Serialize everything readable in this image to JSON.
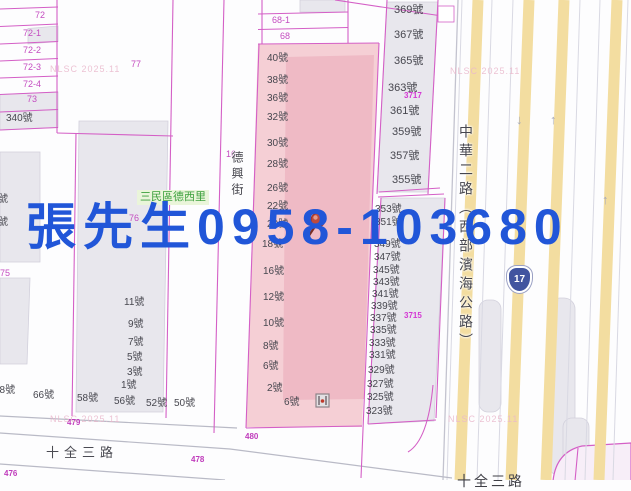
{
  "watermark": {
    "phone": "張先生0958-103680",
    "phone_color": "#2156d8",
    "copyright": "NLSC 2025.11"
  },
  "streets": {
    "dexing": "德興街",
    "zhonghua": "中華二路（西部濱海公路）",
    "shiquan_bottom": "十全三路",
    "shiquan_right": "十全三路",
    "district": "三民區德西里"
  },
  "highway_shield": "17",
  "icons": {
    "arrow_down": "↓",
    "arrow_up": "↑"
  },
  "map_colors": {
    "parcel_line": "#d45fc6",
    "highlight_parcel_fill": "#f5cfd5",
    "highlight_parcel_inner": "#efbac5",
    "building_fill": "#e8e7ed",
    "lane_stripe": "#f3dda0"
  },
  "labels": {
    "addresses": [
      {
        "t": "40號",
        "x": 267,
        "y": 54
      },
      {
        "t": "38號",
        "x": 267,
        "y": 76
      },
      {
        "t": "36號",
        "x": 267,
        "y": 94
      },
      {
        "t": "32號",
        "x": 267,
        "y": 113
      },
      {
        "t": "30號",
        "x": 267,
        "y": 139
      },
      {
        "t": "28號",
        "x": 267,
        "y": 160
      },
      {
        "t": "26號",
        "x": 267,
        "y": 184
      },
      {
        "t": "22號",
        "x": 267,
        "y": 202
      },
      {
        "t": "20號",
        "x": 267,
        "y": 220
      },
      {
        "t": "18號",
        "x": 262,
        "y": 240
      },
      {
        "t": "16號",
        "x": 263,
        "y": 267
      },
      {
        "t": "12號",
        "x": 263,
        "y": 293
      },
      {
        "t": "10號",
        "x": 263,
        "y": 319
      },
      {
        "t": "8號",
        "x": 263,
        "y": 342
      },
      {
        "t": "6號",
        "x": 263,
        "y": 362
      },
      {
        "t": "2號",
        "x": 267,
        "y": 384
      },
      {
        "t": "6號",
        "x": 284,
        "y": 398
      },
      {
        "t": "369號",
        "x": 394,
        "y": 5,
        "s": 11
      },
      {
        "t": "367號",
        "x": 394,
        "y": 30,
        "s": 11
      },
      {
        "t": "365號",
        "x": 394,
        "y": 56,
        "s": 11
      },
      {
        "t": "363號",
        "x": 388,
        "y": 83,
        "s": 11
      },
      {
        "t": "361號",
        "x": 390,
        "y": 106,
        "s": 11
      },
      {
        "t": "359號",
        "x": 392,
        "y": 127,
        "s": 11
      },
      {
        "t": "357號",
        "x": 390,
        "y": 151,
        "s": 11
      },
      {
        "t": "355號",
        "x": 392,
        "y": 175,
        "s": 11
      },
      {
        "t": "353號",
        "x": 375,
        "y": 205
      },
      {
        "t": "351號",
        "x": 375,
        "y": 218
      },
      {
        "t": "349號",
        "x": 374,
        "y": 240
      },
      {
        "t": "347號",
        "x": 374,
        "y": 253
      },
      {
        "t": "345號",
        "x": 373,
        "y": 266
      },
      {
        "t": "343號",
        "x": 373,
        "y": 278
      },
      {
        "t": "341號",
        "x": 372,
        "y": 290
      },
      {
        "t": "339號",
        "x": 371,
        "y": 302
      },
      {
        "t": "337號",
        "x": 370,
        "y": 314
      },
      {
        "t": "335號",
        "x": 370,
        "y": 326
      },
      {
        "t": "333號",
        "x": 369,
        "y": 339
      },
      {
        "t": "331號",
        "x": 369,
        "y": 351
      },
      {
        "t": "329號",
        "x": 368,
        "y": 366
      },
      {
        "t": "327號",
        "x": 367,
        "y": 380
      },
      {
        "t": "325號",
        "x": 367,
        "y": 393
      },
      {
        "t": "323號",
        "x": 366,
        "y": 407
      },
      {
        "t": "11號",
        "x": 124,
        "y": 298
      },
      {
        "t": "9號",
        "x": 128,
        "y": 320
      },
      {
        "t": "7號",
        "x": 128,
        "y": 338
      },
      {
        "t": "5號",
        "x": 127,
        "y": 353
      },
      {
        "t": "3號",
        "x": 127,
        "y": 368
      },
      {
        "t": "1號",
        "x": 121,
        "y": 381
      },
      {
        "t": "68號",
        "x": -6,
        "y": 386
      },
      {
        "t": "66號",
        "x": 33,
        "y": 391
      },
      {
        "t": "58號",
        "x": 77,
        "y": 394
      },
      {
        "t": "56號",
        "x": 114,
        "y": 397
      },
      {
        "t": "52號",
        "x": 146,
        "y": 399
      },
      {
        "t": "50號",
        "x": 174,
        "y": 399
      },
      {
        "t": "340號",
        "x": 6,
        "y": 114
      },
      {
        "t": "號",
        "x": -2,
        "y": 195
      },
      {
        "t": "號",
        "x": -2,
        "y": 218
      }
    ],
    "parcel_ids": [
      {
        "t": "72",
        "x": 35,
        "y": 11
      },
      {
        "t": "72-1",
        "x": 23,
        "y": 29
      },
      {
        "t": "72-2",
        "x": 23,
        "y": 46
      },
      {
        "t": "72-3",
        "x": 23,
        "y": 63
      },
      {
        "t": "72-4",
        "x": 23,
        "y": 80
      },
      {
        "t": "73",
        "x": 27,
        "y": 95
      },
      {
        "t": "77",
        "x": 131,
        "y": 60
      },
      {
        "t": "76",
        "x": 129,
        "y": 214
      },
      {
        "t": "75",
        "x": 0,
        "y": 269
      },
      {
        "t": "16",
        "x": 226,
        "y": 150
      },
      {
        "t": "68-1",
        "x": 272,
        "y": 16
      },
      {
        "t": "68",
        "x": 280,
        "y": 32
      }
    ],
    "lot_ids": [
      {
        "t": "3717",
        "x": 404,
        "y": 92
      },
      {
        "t": "3715",
        "x": 404,
        "y": 312
      }
    ],
    "road_ids": [
      {
        "t": "479",
        "x": 67,
        "y": 419
      },
      {
        "t": "480",
        "x": 245,
        "y": 433
      },
      {
        "t": "478",
        "x": 191,
        "y": 456
      },
      {
        "t": "476",
        "x": 4,
        "y": 470
      }
    ]
  }
}
